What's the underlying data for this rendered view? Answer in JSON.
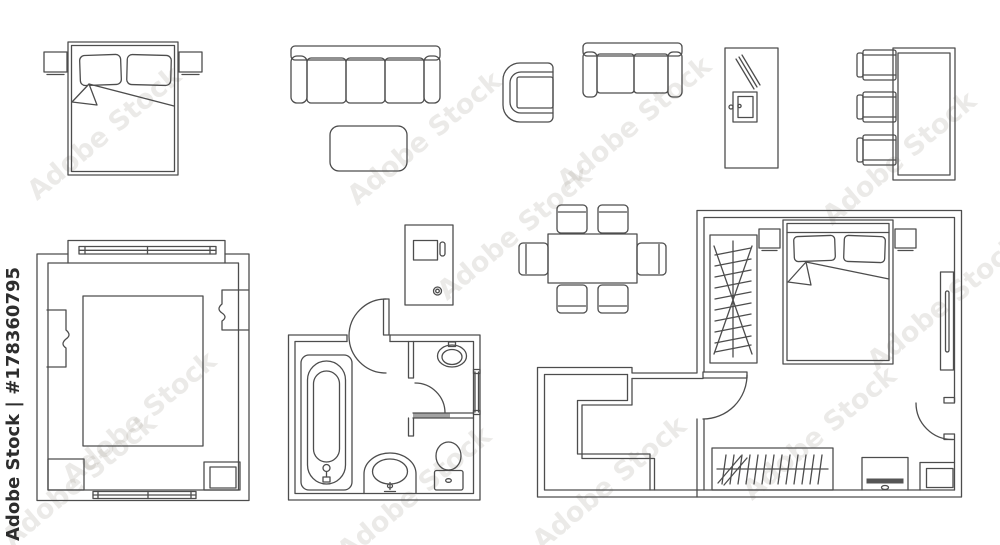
{
  "watermark": {
    "brand": "Adobe Stock",
    "credit": "Adobe Stock | #178360795",
    "asset_number": "178360795"
  },
  "palette": {
    "line": "#4d4d4d",
    "bg": "#ffffff",
    "wm_faint": "#8f887b",
    "wm_dark": "#2d2d2d",
    "fill_dark": "#555555"
  },
  "diagram": {
    "kind": "floor-plan-furniture-symbols-line-set",
    "symbols": [
      "double-bed-with-nightstands",
      "three-seat-sofa",
      "coffee-table",
      "armchair",
      "two-seat-sofa",
      "tall-cabinet",
      "table-with-three-chairs",
      "living-room-plan",
      "washing-machine",
      "dining-table-with-six-chairs",
      "bathroom-plan",
      "apartment-bedroom-plan"
    ]
  }
}
